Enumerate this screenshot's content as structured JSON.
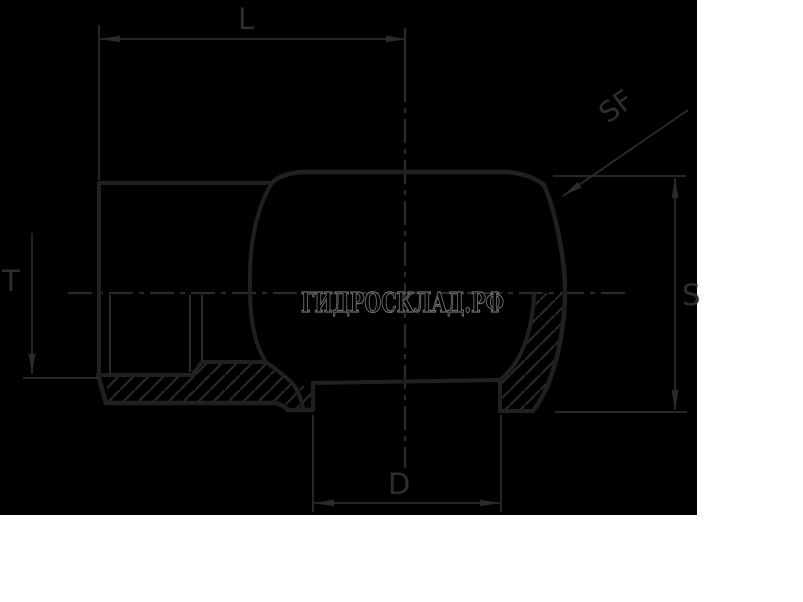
{
  "drawing": {
    "type": "technical-section-view",
    "labels": {
      "length": "L",
      "sphere_face": "SF",
      "thread_depth": "T",
      "across_flats": "S",
      "diameter": "D"
    },
    "watermark": "ГИДРОСКЛАД.РФ",
    "colors": {
      "page_background": "#ffffff",
      "canvas_background": "#000000",
      "thin_line": "#2b2b2b",
      "thick_outline": "#202020",
      "centerline": "#2a2a2a",
      "label_text": "#2e2e2e",
      "watermark_stroke": "#6e6e6e"
    }
  }
}
